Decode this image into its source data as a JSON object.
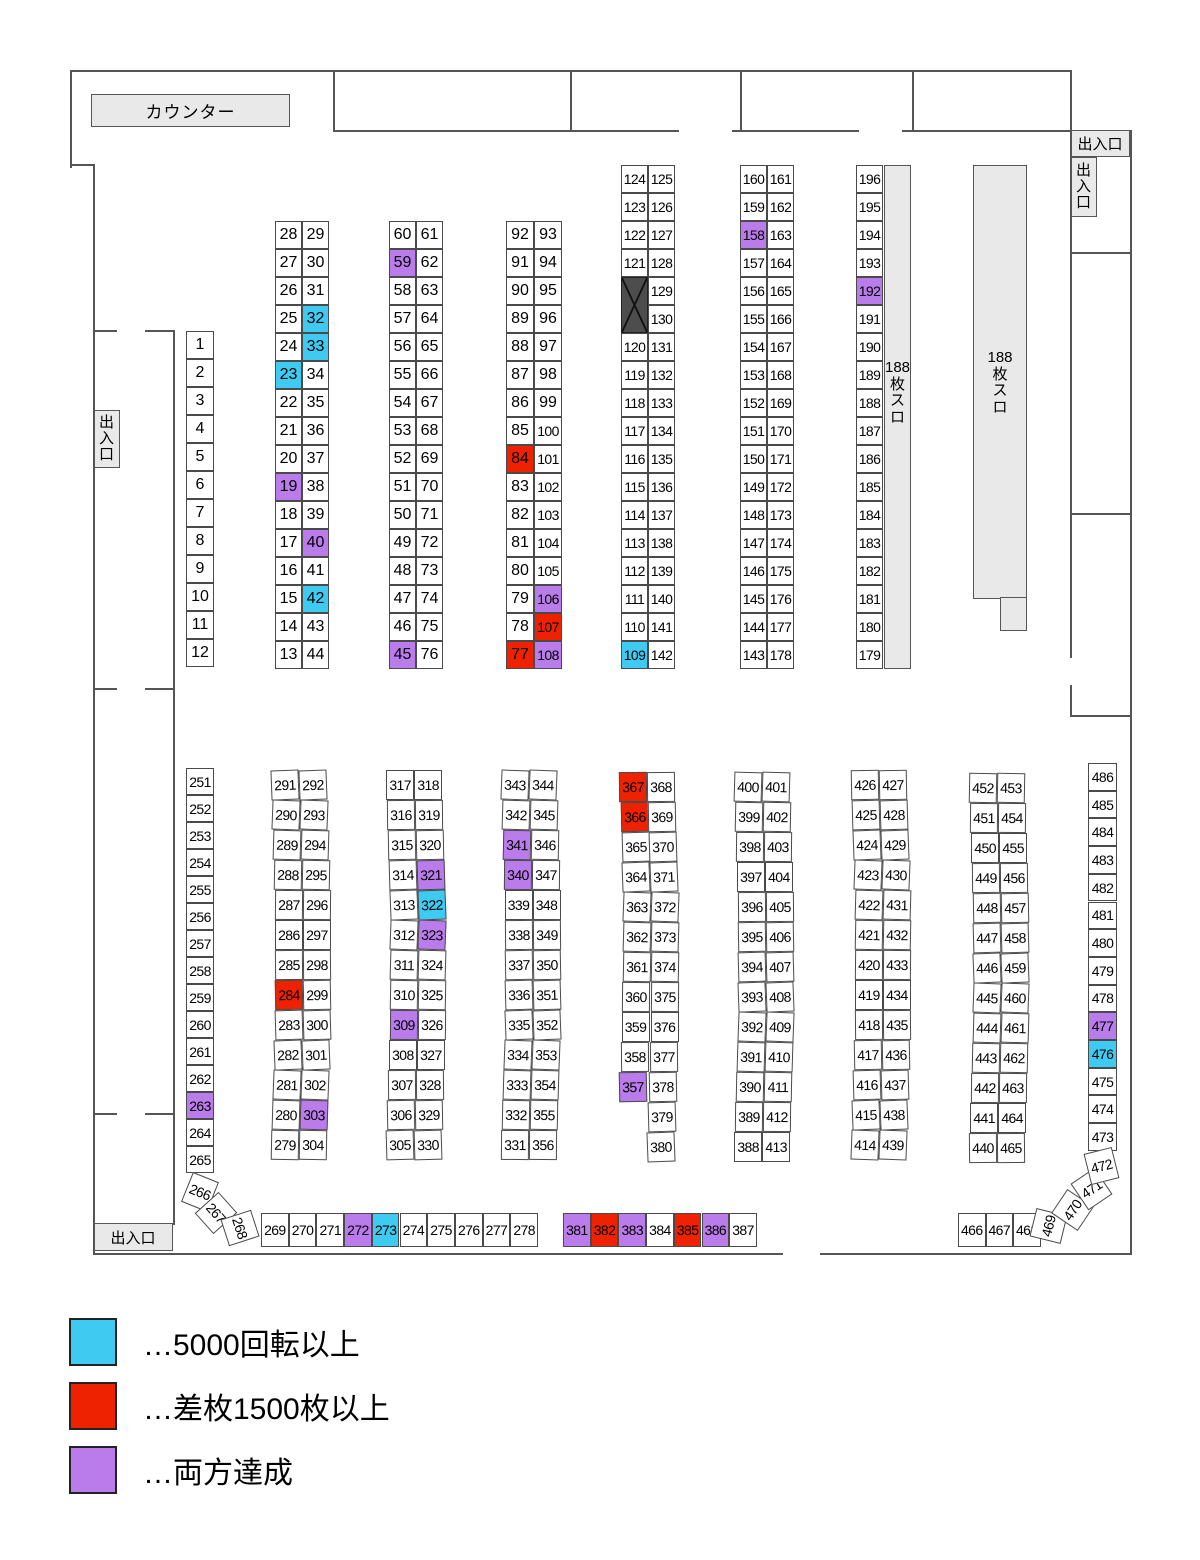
{
  "map": {
    "counter_label": "カウンター",
    "entrance_label": "出入口",
    "slot_strip_label": "188枚スロ"
  },
  "legend": {
    "items": [
      {
        "key": "cyan",
        "color": "#3FCBF1",
        "label": "…5000回転以上"
      },
      {
        "key": "red",
        "color": "#EE2200",
        "label": "…差枚1500枚以上"
      },
      {
        "key": "purple",
        "color": "#BA7BEB",
        "label": "…両方達成"
      }
    ]
  },
  "seats": {
    "colA": [
      1,
      2,
      3,
      4,
      5,
      6,
      7,
      8,
      9,
      10,
      11,
      12
    ],
    "colB_left": [
      28,
      27,
      26,
      25,
      24,
      23,
      22,
      21,
      20,
      19,
      18,
      17,
      16,
      15,
      14,
      13
    ],
    "colB_right": [
      29,
      30,
      31,
      32,
      33,
      34,
      35,
      36,
      37,
      38,
      39,
      40,
      41,
      42,
      43,
      44
    ],
    "colC_left": [
      60,
      59,
      58,
      57,
      56,
      55,
      54,
      53,
      52,
      51,
      50,
      49,
      48,
      47,
      46,
      45
    ],
    "colC_right": [
      61,
      62,
      63,
      64,
      65,
      66,
      67,
      68,
      69,
      70,
      71,
      72,
      73,
      74,
      75,
      76
    ],
    "colD_left": [
      92,
      91,
      90,
      89,
      88,
      87,
      86,
      85,
      84,
      83,
      82,
      81,
      80,
      79,
      78,
      77
    ],
    "colD_right": [
      93,
      94,
      95,
      96,
      97,
      98,
      99,
      100,
      101,
      102,
      103,
      104,
      105,
      106,
      107,
      108
    ],
    "colE_left": [
      124,
      123,
      122,
      121,
      "X",
      120,
      119,
      118,
      117,
      116,
      115,
      114,
      113,
      112,
      111,
      110,
      109
    ],
    "colE_right": [
      125,
      126,
      127,
      128,
      129,
      130,
      131,
      132,
      133,
      134,
      135,
      136,
      137,
      138,
      139,
      140,
      141,
      142
    ],
    "colF_left": [
      160,
      159,
      158,
      157,
      156,
      155,
      154,
      153,
      152,
      151,
      150,
      149,
      148,
      147,
      146,
      145,
      144,
      143
    ],
    "colF_right": [
      161,
      162,
      163,
      164,
      165,
      166,
      167,
      168,
      169,
      170,
      171,
      172,
      173,
      174,
      175,
      176,
      177,
      178
    ],
    "colG": [
      196,
      195,
      194,
      193,
      192,
      191,
      190,
      189,
      188,
      187,
      186,
      185,
      184,
      183,
      182,
      181,
      180,
      179
    ],
    "colL": [
      251,
      252,
      253,
      254,
      255,
      256,
      257,
      258,
      259,
      260,
      261,
      262,
      263,
      264,
      265
    ],
    "curveL": [
      266,
      267,
      268
    ],
    "row269": [
      269,
      270,
      271,
      272,
      273,
      274,
      275,
      276,
      277,
      278
    ],
    "p1_left": [
      291,
      290,
      289,
      288,
      287,
      286,
      285,
      284,
      283,
      282,
      281,
      280,
      279
    ],
    "p1_right": [
      292,
      293,
      294,
      295,
      296,
      297,
      298,
      299,
      300,
      301,
      302,
      303,
      304
    ],
    "p2_left": [
      317,
      316,
      315,
      314,
      313,
      312,
      311,
      310,
      309,
      308,
      307,
      306,
      305
    ],
    "p2_right": [
      318,
      319,
      320,
      321,
      322,
      323,
      324,
      325,
      326,
      327,
      328,
      329,
      330
    ],
    "p3_left": [
      343,
      342,
      341,
      340,
      339,
      338,
      337,
      336,
      335,
      334,
      333,
      332,
      331
    ],
    "p3_right": [
      344,
      345,
      346,
      347,
      348,
      349,
      350,
      351,
      352,
      353,
      354,
      355,
      356
    ],
    "p4_left": [
      367,
      366,
      365,
      364,
      363,
      362,
      361,
      360,
      359,
      358,
      357
    ],
    "p4_right": [
      368,
      369,
      370,
      371,
      372,
      373,
      374,
      375,
      376,
      377,
      378,
      379,
      380
    ],
    "row381": [
      381,
      382,
      383,
      384,
      385,
      386,
      387
    ],
    "p5_left": [
      400,
      399,
      398,
      397,
      396,
      395,
      394,
      393,
      392,
      391,
      390,
      389,
      388
    ],
    "p5_right": [
      401,
      402,
      403,
      404,
      405,
      406,
      407,
      408,
      409,
      410,
      411,
      412,
      413
    ],
    "p6_left": [
      426,
      425,
      424,
      423,
      422,
      421,
      420,
      419,
      418,
      417,
      416,
      415,
      414
    ],
    "p6_right": [
      427,
      428,
      429,
      430,
      431,
      432,
      433,
      434,
      435,
      436,
      437,
      438,
      439
    ],
    "p7_left": [
      452,
      451,
      450,
      449,
      448,
      447,
      446,
      445,
      444,
      443,
      442,
      441,
      440
    ],
    "p7_right": [
      453,
      454,
      455,
      456,
      457,
      458,
      459,
      460,
      461,
      462,
      463,
      464,
      465
    ],
    "row466": [
      466,
      467,
      468
    ],
    "curveR": [
      469,
      470,
      471,
      472
    ],
    "colR": [
      486,
      485,
      484,
      483,
      482,
      481,
      480,
      479,
      478,
      477,
      476,
      475,
      474,
      473
    ]
  },
  "highlights": {
    "cyan": [
      23,
      32,
      33,
      42,
      109,
      273,
      322,
      476
    ],
    "red": [
      77,
      84,
      107,
      284,
      366,
      367,
      382,
      385
    ],
    "purple": [
      19,
      40,
      45,
      59,
      106,
      108,
      158,
      192,
      263,
      272,
      303,
      309,
      321,
      323,
      340,
      341,
      357,
      381,
      383,
      386,
      477
    ]
  },
  "blocked_marker": "X"
}
